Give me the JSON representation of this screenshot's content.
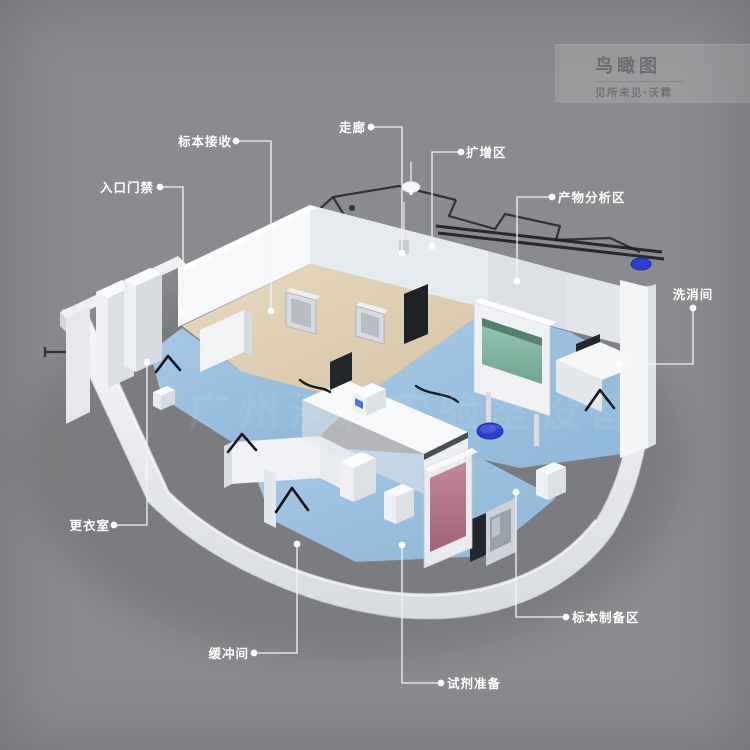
{
  "scene": {
    "background_color": "#8A8B8E",
    "watermark_text": "广州沃霖实验室设备"
  },
  "title_block": {
    "title": "鸟瞰图",
    "subtitle": "见所未见·沃霖"
  },
  "colors": {
    "label_text": "#FFFFFF",
    "leader_line": "#F4F4F6",
    "blueprint_line": "#26272B",
    "wall_white": "#F4F5F7",
    "wall_shadow": "#CDD1D7",
    "floor_blue": "#9CC1E0",
    "floor_tan": "#DFD0B6",
    "cabinet_glass_teal": "#8FC0AD",
    "cabinet_interior_pink": "#B5798C",
    "stool_blue": "#3240CF",
    "equipment_dark": "#23262C"
  },
  "labels": [
    {
      "name": "specimen-receiving",
      "text": "标本接收",
      "text_x": 232,
      "text_y": 146,
      "anchor": "end",
      "line": [
        [
          236,
          141
        ],
        [
          271,
          141
        ],
        [
          271,
          311
        ]
      ]
    },
    {
      "name": "entrance-access",
      "text": "入口门禁",
      "text_x": 154,
      "text_y": 192,
      "anchor": "end",
      "line": [
        [
          160,
          187
        ],
        [
          183,
          187
        ],
        [
          183,
          312
        ]
      ]
    },
    {
      "name": "corridor",
      "text": "走廊",
      "text_x": 366,
      "text_y": 132,
      "anchor": "end",
      "line": [
        [
          371,
          127
        ],
        [
          402,
          127
        ],
        [
          402,
          253
        ]
      ]
    },
    {
      "name": "amplification-area",
      "text": "扩增区",
      "text_x": 466,
      "text_y": 157,
      "anchor": "start",
      "line": [
        [
          461,
          152
        ],
        [
          432,
          152
        ],
        [
          432,
          246
        ]
      ]
    },
    {
      "name": "product-analysis-area",
      "text": "产物分析区",
      "text_x": 558,
      "text_y": 202,
      "anchor": "start",
      "line": [
        [
          552,
          197
        ],
        [
          517,
          197
        ],
        [
          517,
          281
        ]
      ]
    },
    {
      "name": "washing-room",
      "text": "洗消间",
      "text_x": 693,
      "text_y": 299,
      "anchor": "middle",
      "line": [
        [
          693,
          308
        ],
        [
          693,
          364
        ],
        [
          619,
          364
        ]
      ]
    },
    {
      "name": "changing-room",
      "text": "更衣室",
      "text_x": 110,
      "text_y": 530,
      "anchor": "end",
      "line": [
        [
          114,
          525
        ],
        [
          147,
          525
        ],
        [
          147,
          362
        ]
      ]
    },
    {
      "name": "buffer-room",
      "text": "缓冲间",
      "text_x": 249,
      "text_y": 658,
      "anchor": "end",
      "line": [
        [
          254,
          653
        ],
        [
          297,
          653
        ],
        [
          297,
          544
        ]
      ]
    },
    {
      "name": "reagent-preparation",
      "text": "试剂准备",
      "text_x": 447,
      "text_y": 688,
      "anchor": "start",
      "line": [
        [
          441,
          683
        ],
        [
          402,
          683
        ],
        [
          402,
          545
        ]
      ]
    },
    {
      "name": "specimen-preparation-area",
      "text": "标本制备区",
      "text_x": 572,
      "text_y": 622,
      "anchor": "start",
      "line": [
        [
          566,
          617
        ],
        [
          516,
          617
        ],
        [
          516,
          492
        ]
      ]
    }
  ]
}
